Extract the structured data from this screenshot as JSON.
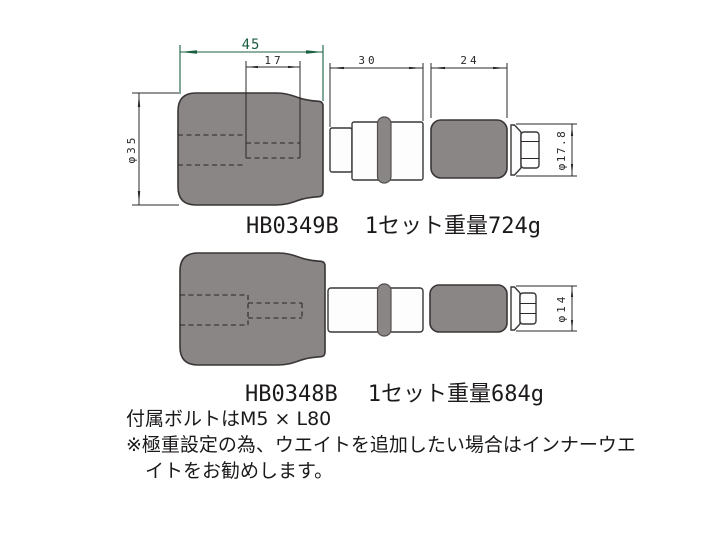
{
  "colors": {
    "background": "#ffffff",
    "part_fill": "#8b8686",
    "outline": "#3a3636",
    "dim_line": "#2b2727",
    "highlight_dim": "#1a5f40",
    "text": "#1c1919"
  },
  "drawing_top": {
    "model": "HB0349B",
    "set_weight": "1セット重量724g",
    "dims": {
      "overall_length": "45",
      "bore_depth": "17",
      "adapter_length": "30",
      "outer_weight_length": "24",
      "body_dia": "φ35",
      "end_dia": "φ17.8"
    }
  },
  "drawing_bottom": {
    "model": "HB0348B",
    "set_weight": "1セット重量684g",
    "dims": {
      "end_dia": "φ14"
    }
  },
  "notes": {
    "bolt": "付属ボルトはM5 × L80",
    "warn_line1": "※極重設定の為、ウエイトを追加したい場合はインナーウエ",
    "warn_line2": "イトをお勧めします。"
  }
}
